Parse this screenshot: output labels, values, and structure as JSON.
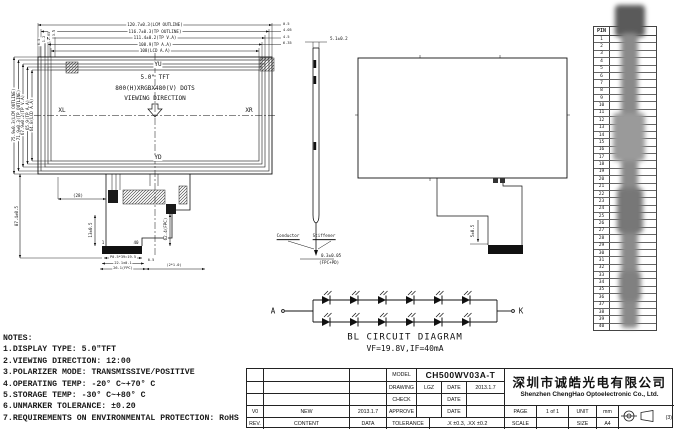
{
  "drawing": {
    "front_view": {
      "center_lines": [
        "5.0\" TFT",
        "800(H)XRGBX480(V) DOTS",
        "VIEWING DIRECTION"
      ],
      "dir_top": "YU",
      "dir_bottom": "YD",
      "dir_left": "XL",
      "dir_right": "XR",
      "h_dims": [
        "120.7±0.3(LCM OUTLINE)",
        "116.7±0.3(TP OUTLINE)",
        "111.4±0.2(TP V.A)",
        "108.9(TP A.A)",
        "108(LCD A.A)"
      ],
      "v_dims": [
        "75.9±0.3(LCM OUTLINE)",
        "71.9±0.3(TP OUTLINE)",
        "67.9±0.2(TP V.A)",
        "65.9(TP A.A)",
        "64.8(LCD A.A)"
      ],
      "right_gaps": [
        "0.5",
        "4.05",
        "4.5",
        "6.35"
      ],
      "top_gaps": [
        "0.5",
        "1.2",
        "2.05",
        "3.5"
      ]
    },
    "fpc_front": {
      "dim_w28": "(28)",
      "dim_h87": "87.4±0.5",
      "dim_13": "13±0.5",
      "dim_62": "62.4(FPC)",
      "pin_first": "1",
      "pin_last": "40",
      "dim_pitch": "P0.5*39=19.5",
      "dim_22": "22.1±0.1",
      "dim_26": "26.1(FPC)",
      "dim_05": "0.5",
      "dim_2x1": "(2*1.0)"
    },
    "side_view": {
      "dim_top": "5.1±0.2",
      "label_conductor": "Conductor",
      "label_stiffener": "Stiffener",
      "dim_fpc": "0.3±0.05",
      "fpc_pd": "(FPC+PD)"
    },
    "back_view": {
      "dim_5": "5±0.5"
    }
  },
  "pin_table": {
    "header": "PIN",
    "pins": [
      "1",
      "2",
      "3",
      "4",
      "5",
      "6",
      "7",
      "8",
      "9",
      "10",
      "11",
      "12",
      "13",
      "14",
      "15",
      "16",
      "17",
      "18",
      "19",
      "20",
      "21",
      "22",
      "23",
      "24",
      "25",
      "26",
      "27",
      "28",
      "29",
      "30",
      "31",
      "32",
      "33",
      "34",
      "35",
      "36",
      "37",
      "38",
      "39",
      "40"
    ]
  },
  "bl_circuit": {
    "anode": "A",
    "cathode": "K",
    "title": "BL CIRCUIT DIAGRAM",
    "spec": "VF=19.8V,IF=40mA",
    "rows": 2,
    "leds_per_row": 6
  },
  "notes": {
    "title": "NOTES:",
    "items": [
      "1.DISPLAY TYPE:  5.0\"TFT",
      "2.VIEWING DIRECTION: 12:00",
      "3.POLARIZER MODE: TRANSMISSIVE/POSITIVE",
      "4.OPERATING TEMP: -20° C~+70° C",
      "5.STORAGE TEMP: -30° C~+80° C",
      "6.UNMARKER TOLERANCE: ±0.20",
      "7.REQUIREMENTS ON ENVIRONMENTAL PROTECTION: RoHS"
    ]
  },
  "title_block": {
    "rev_row": {
      "rev": "V0",
      "content": "NEW",
      "date": "2013.1.7"
    },
    "footer_row": {
      "rev": "REV.",
      "content": "CONTENT",
      "date": "DATA"
    },
    "model_label": "MODEL",
    "model_value": "CH500WV03A-T",
    "drawing_label": "DRAWING",
    "drawing_value": "LGZ",
    "check_label": "CHECK",
    "approve_label": "APPROVE",
    "date_label": "DATE",
    "drawing_date": "2013.1.7",
    "tolerance_label": "TOLERANCE",
    "tolerance_value": ".X ±0.3, .XX ±0.2",
    "company_cn": "深圳市诚皓光电有限公司",
    "company_en": "Shenzhen ChengHao Optoelectronic Co., Ltd.",
    "page_label": "PAGE",
    "page_value": "1 of 1",
    "unit_label": "UNIT",
    "unit_value": "mm",
    "scale_label": "SCALE",
    "scale_value": "",
    "size_label": "SIZE",
    "size_value": "A4",
    "projection_note": "(3)"
  }
}
